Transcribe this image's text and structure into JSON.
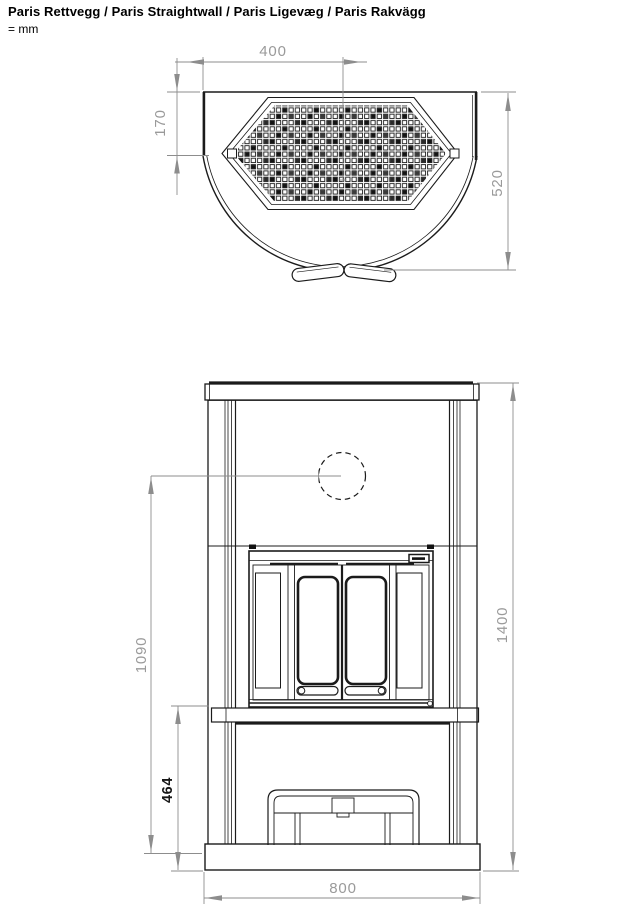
{
  "title": "Paris Rettvegg / Paris Straightwall / Paris Ligevæg / Paris Rakvägg",
  "unit_note": "= mm",
  "colors": {
    "line": "#1b1b1b",
    "dimension_line": "#8d8d8d",
    "dimension_text": "#9a9a9a",
    "background": "#ffffff"
  },
  "top_view": {
    "dimensions": {
      "center_offset": "400",
      "grille_depth": "170",
      "total_depth": "520"
    }
  },
  "front_view": {
    "dimensions": {
      "flue_center_height": "1090",
      "base_height": "464",
      "total_height": "1400",
      "total_width": "800"
    }
  }
}
